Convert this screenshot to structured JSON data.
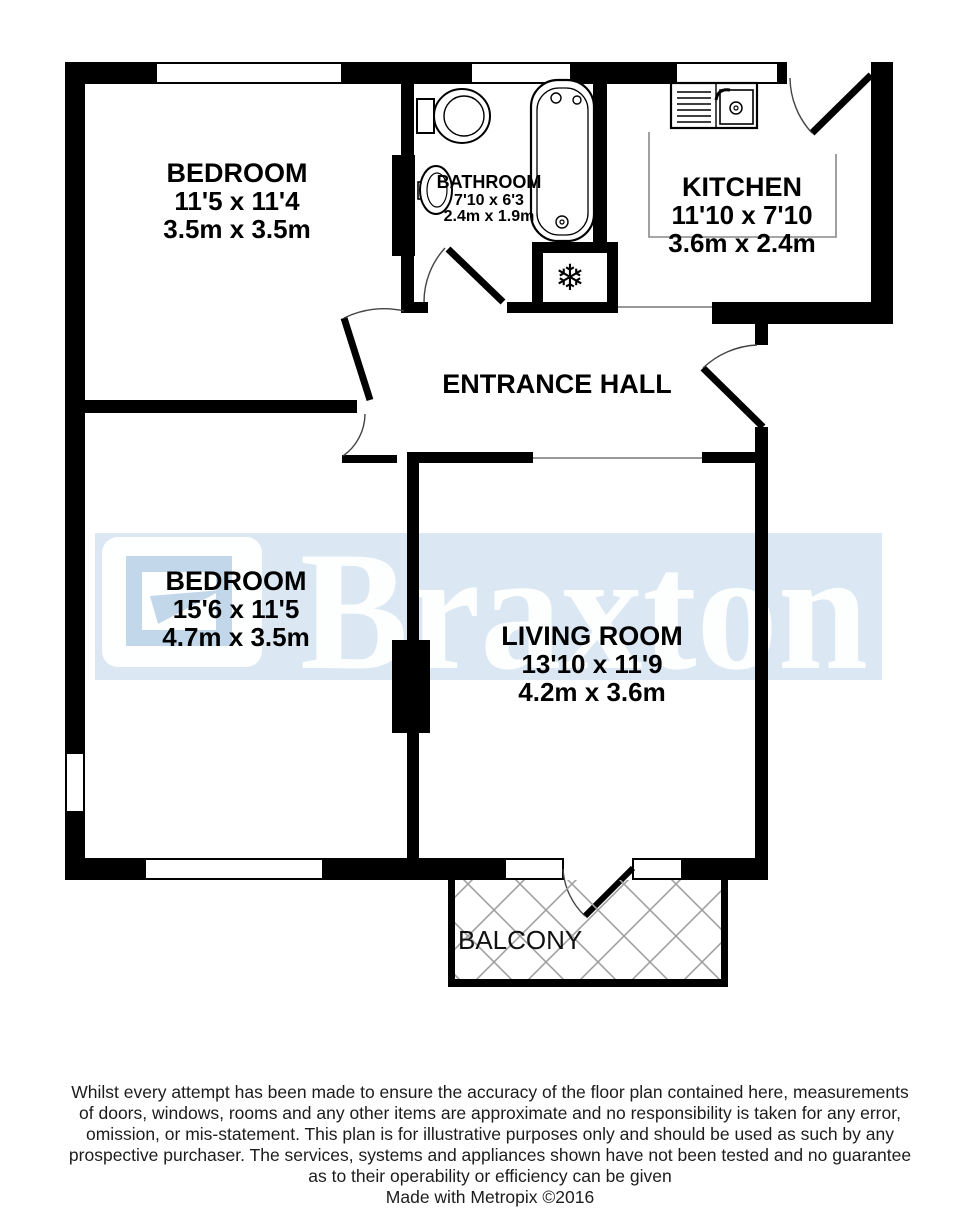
{
  "watermark": {
    "brand": "Braxton",
    "band_color": "#dbe8f4",
    "logo_accent_color": "#c3d7ea",
    "text_color": "#ffffff"
  },
  "colors": {
    "wall": "#000000",
    "background": "#ffffff",
    "lattice": "#a0a0a0"
  },
  "icons": {
    "snowflake": "❄"
  },
  "rooms": [
    {
      "id": "bedroom-1",
      "name": "BEDROOM",
      "imperial": "11'5 x 11'4",
      "metric": "3.5m x 3.5m"
    },
    {
      "id": "bathroom",
      "name": "BATHROOM",
      "imperial": "7'10 x 6'3",
      "metric": "2.4m x 1.9m"
    },
    {
      "id": "kitchen",
      "name": "KITCHEN",
      "imperial": "11'10 x 7'10",
      "metric": "3.6m x 2.4m"
    },
    {
      "id": "entrance-hall",
      "name": "ENTRANCE HALL"
    },
    {
      "id": "bedroom-2",
      "name": "BEDROOM",
      "imperial": "15'6 x 11'5",
      "metric": "4.7m x 3.5m"
    },
    {
      "id": "living-room",
      "name": "LIVING ROOM",
      "imperial": "13'10 x 11'9",
      "metric": "4.2m x 3.6m"
    },
    {
      "id": "balcony",
      "name": "BALCONY"
    }
  ],
  "disclaimer": {
    "lines": [
      "Whilst every attempt has been made to ensure the accuracy of the floor plan contained here, measurements",
      "of doors, windows, rooms and any other items are approximate and no responsibility is taken for any error,",
      "omission, or mis-statement. This plan is for illustrative purposes only and should be used as such by any",
      "prospective purchaser. The services, systems and appliances shown have not been tested and no guarantee",
      "as to their operability or efficiency can be given",
      "Made with Metropix ©2016"
    ]
  }
}
